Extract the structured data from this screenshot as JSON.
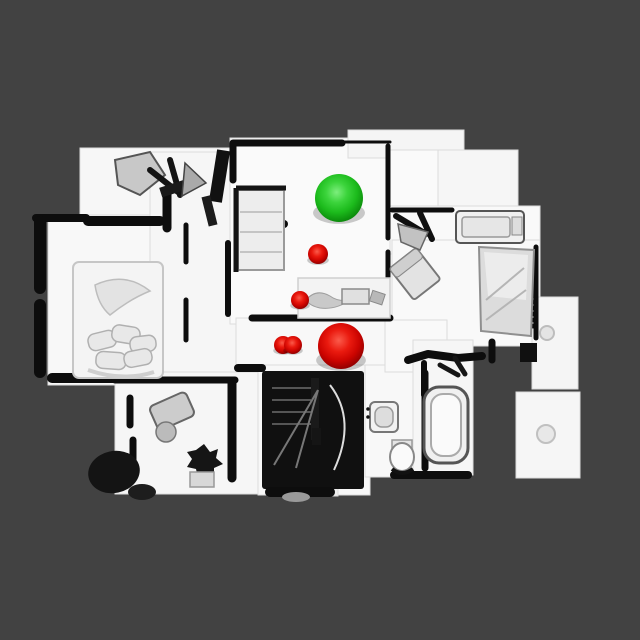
{
  "viewport": {
    "description": "top-down orthographic view of a 3D-scanned house floor plan",
    "background_color": "#424242",
    "floor_color": "#f8f8f8",
    "wall_color": "#0d0d0d",
    "marker_colors": {
      "green": "#22c822",
      "red": "#e01010"
    }
  },
  "markers": [
    {
      "id": "green-sphere-large",
      "color": "green",
      "cx": 339,
      "cy": 198,
      "r": 24
    },
    {
      "id": "red-sphere-1",
      "color": "red",
      "cx": 318,
      "cy": 254,
      "r": 10
    },
    {
      "id": "red-sphere-2",
      "color": "red",
      "cx": 300,
      "cy": 300,
      "r": 9
    },
    {
      "id": "red-sphere-3a",
      "color": "red",
      "cx": 283,
      "cy": 345,
      "r": 9
    },
    {
      "id": "red-sphere-3b",
      "color": "red",
      "cx": 293,
      "cy": 345,
      "r": 9
    },
    {
      "id": "red-sphere-large",
      "color": "red",
      "cx": 341,
      "cy": 346,
      "r": 23
    }
  ]
}
